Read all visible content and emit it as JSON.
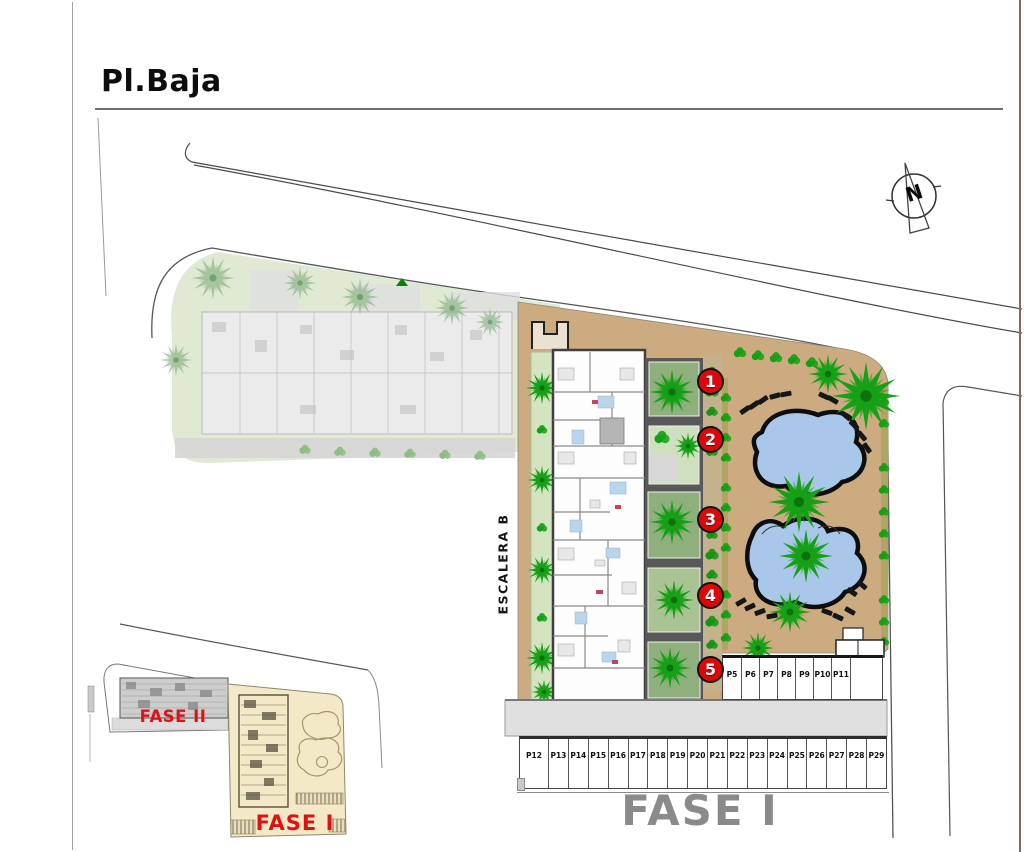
{
  "title": "Pl.Baja",
  "compass": {
    "label": "N"
  },
  "labels": {
    "escalera": "ESCALERA B",
    "fase1_main": "FASE I",
    "inset_fase2": "FASE II",
    "inset_fase1": "FASE I"
  },
  "unit_markers": [
    "1",
    "2",
    "3",
    "4",
    "5"
  ],
  "parking": {
    "row_right": [
      "P5",
      "P6",
      "P7",
      "P8",
      "P9",
      "P10",
      "P11",
      ""
    ],
    "row_bottom": [
      "P12",
      "P13",
      "P14",
      "P15",
      "P16",
      "P17",
      "P18",
      "P19",
      "P20",
      "P21",
      "P22",
      "P23",
      "P24",
      "P25",
      "P26",
      "P27",
      "P28",
      "P29"
    ]
  },
  "colors": {
    "marker_red": "#de0606",
    "phase_text_red": "#e01111",
    "fase1_gray": "#8a8a8a",
    "pool_blue": "#a9c7e8",
    "deck_tan": "#ccab80",
    "garden_green": "#d4e3c0",
    "tree_green": "#17a017",
    "inset_yellow": "#f3e9c6"
  }
}
